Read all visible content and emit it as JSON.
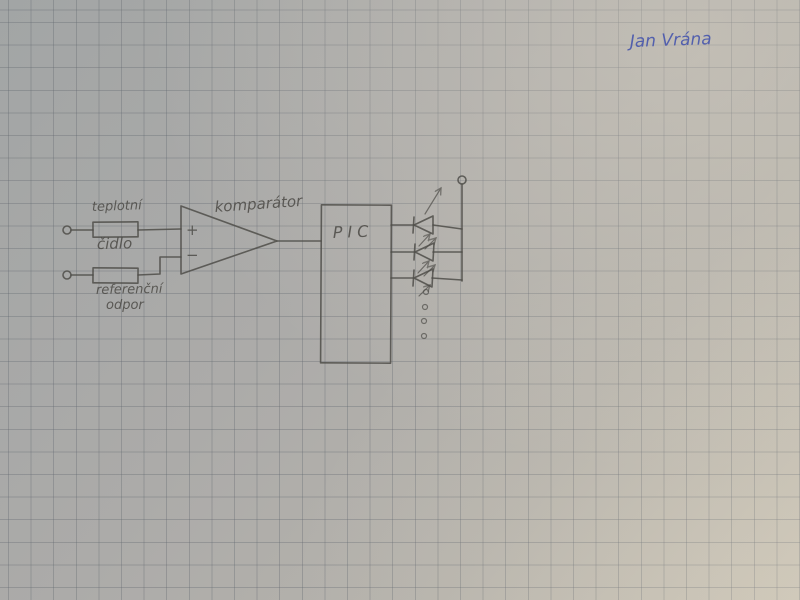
{
  "signature": {
    "text": "Jan Vrána"
  },
  "labels": {
    "sensor_line1": "teplotní",
    "sensor_line2": "čidlo",
    "reference_line1": "referenční",
    "reference_line2": "odpor",
    "comparator": "komparátor",
    "plus": "+",
    "minus": "−",
    "pic": "PIC"
  },
  "leds": {
    "drawn_count": 3,
    "continuation_dots": 4
  },
  "colors": {
    "paper": "#adaca9",
    "grid": "#60666e",
    "pencil": "#4f4d49",
    "ink": "#4756ad"
  }
}
